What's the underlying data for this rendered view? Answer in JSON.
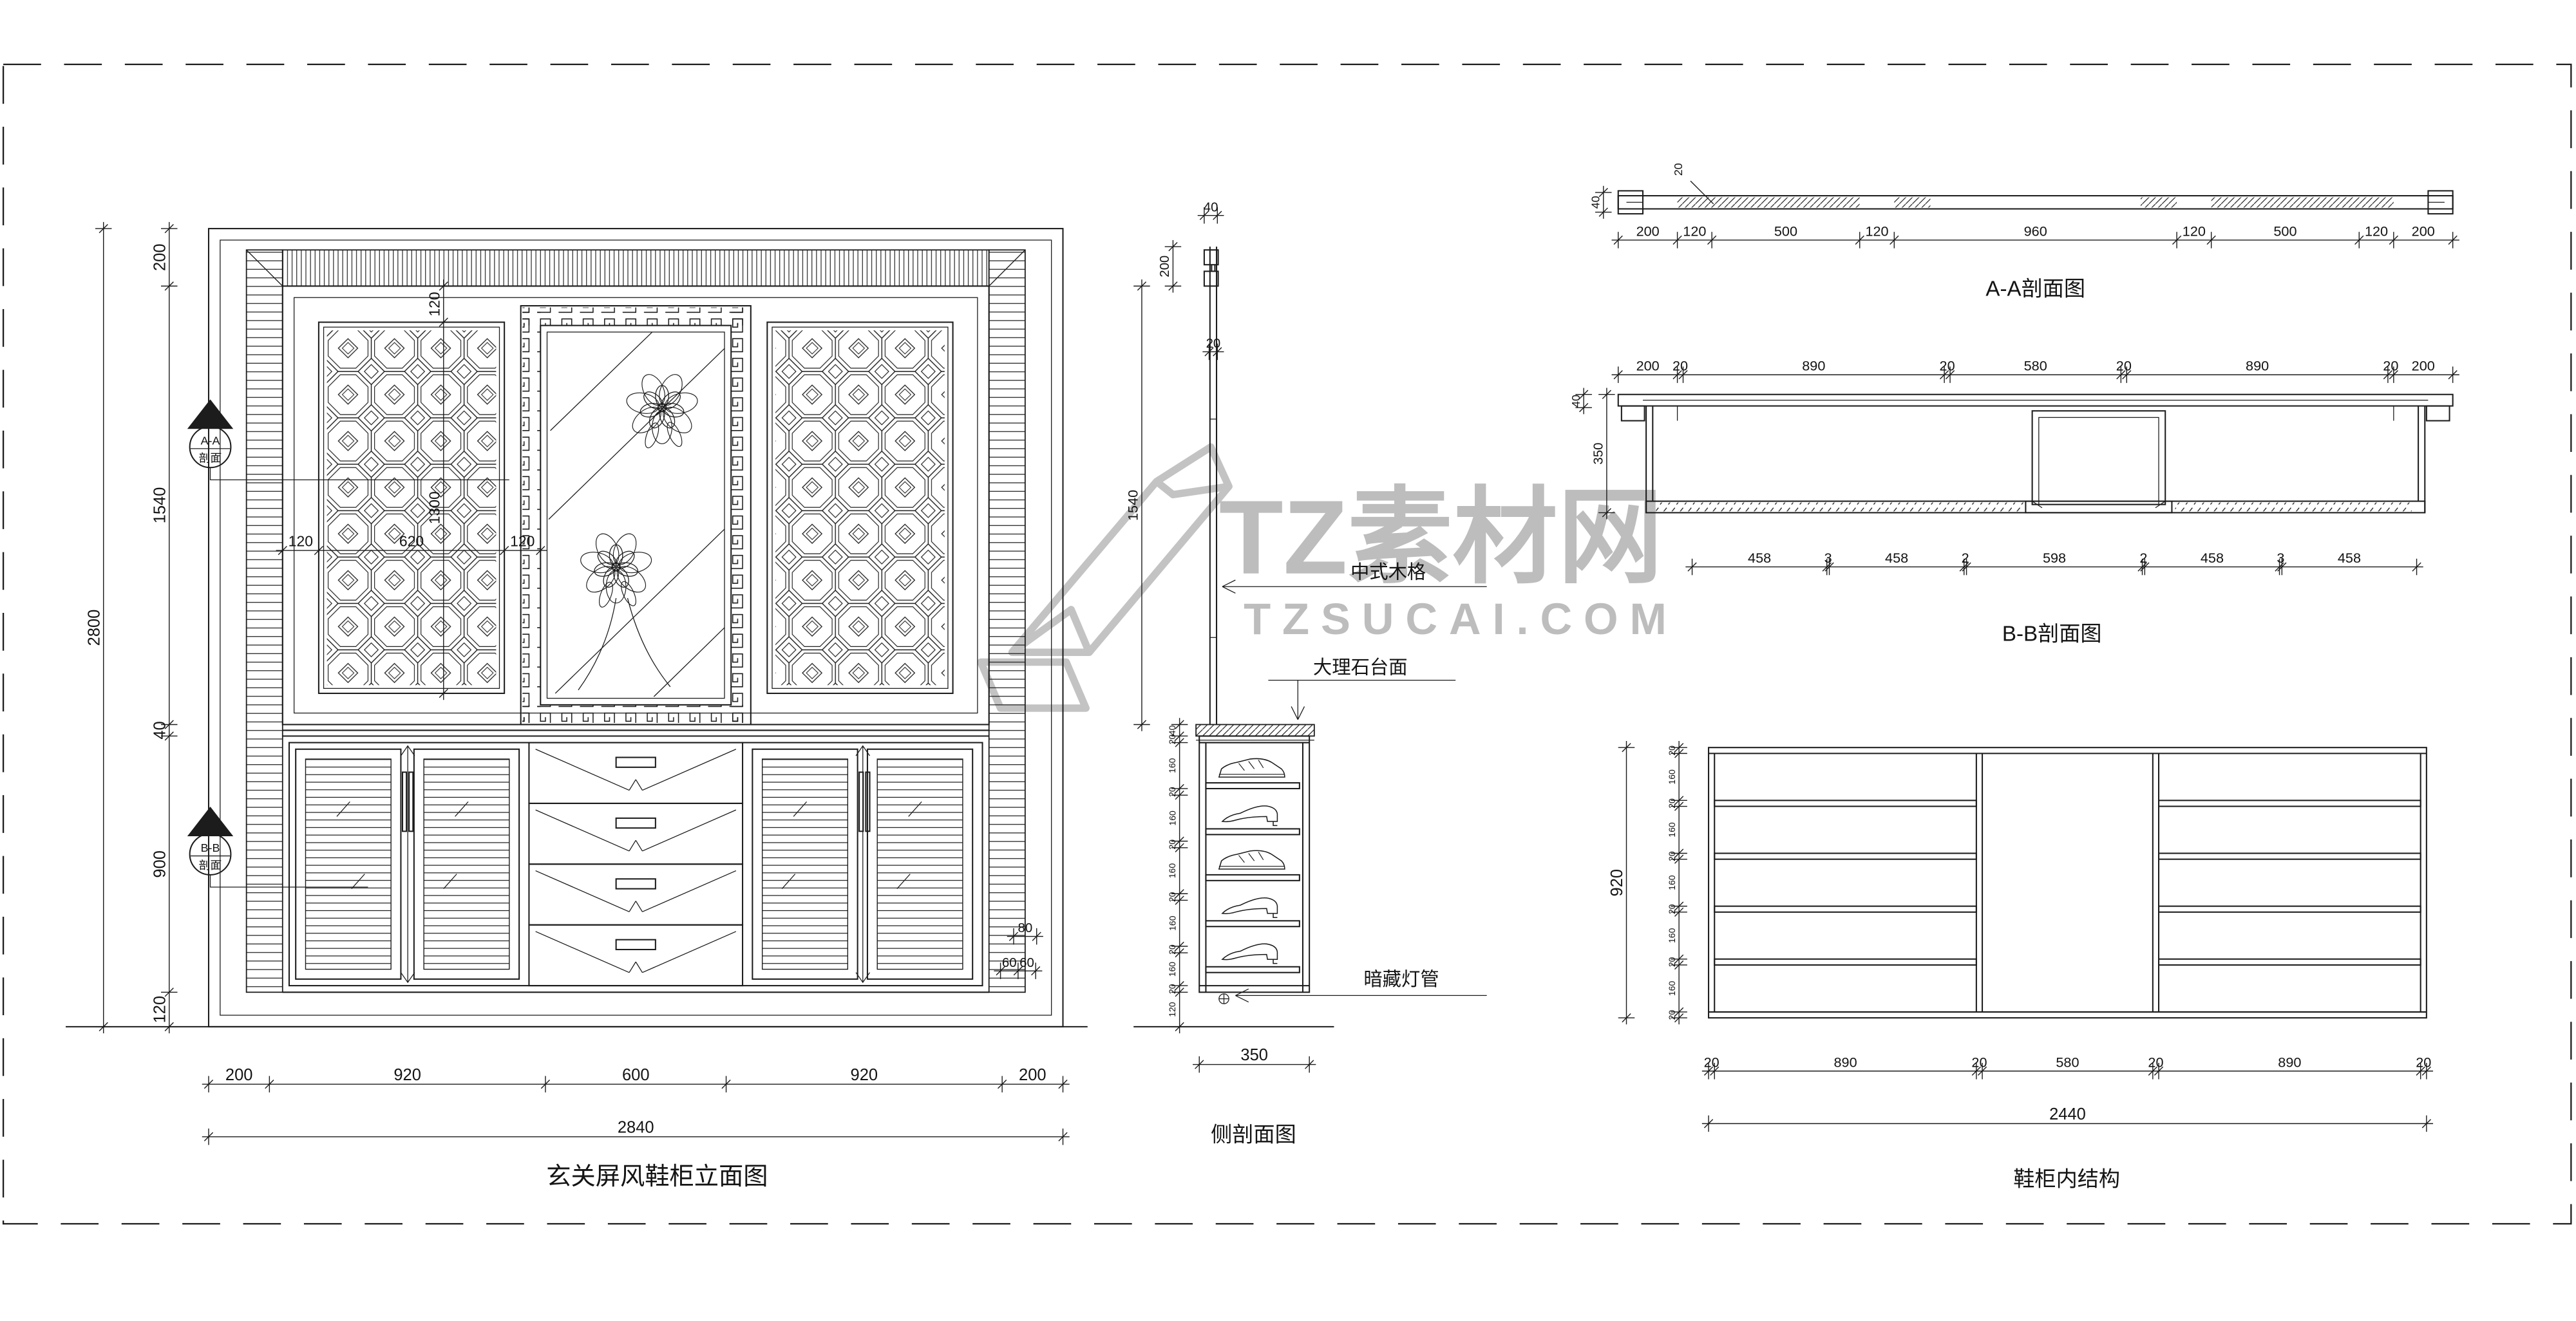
{
  "sheet": {
    "background": "#ffffff",
    "line_color": "#1c1c1c",
    "watermark_color": "#bdbdbd"
  },
  "watermark": {
    "brand": "TZ素材网",
    "domain": "TZSUCAI.COM"
  },
  "views": {
    "elevation": {
      "title": "玄关屏风鞋柜立面图",
      "section_markers": [
        {
          "name": "A-A",
          "caption": "剖面"
        },
        {
          "name": "B-B",
          "caption": "剖面"
        }
      ]
    },
    "side_section": {
      "title": "侧剖面图",
      "callouts": {
        "wood_lattice": "中式木格",
        "marble_top": "大理石台面",
        "hidden_light": "暗藏灯管"
      }
    },
    "section_aa": {
      "title": "A-A剖面图",
      "panel_thickness": "20"
    },
    "section_bb": {
      "title": "B-B剖面图"
    },
    "internal": {
      "title": "鞋柜内结构"
    }
  },
  "dim_chains": {
    "elev_bottom_segs": {
      "dir": "h",
      "pos": 660,
      "ticks": [
        127,
        164,
        332,
        442,
        610,
        647
      ],
      "labels": [
        "200",
        "920",
        "600",
        "920",
        "200"
      ],
      "size": 10
    },
    "elev_bottom_total": {
      "dir": "h",
      "pos": 692,
      "ticks": [
        127,
        647
      ],
      "labels": [
        "2840"
      ],
      "size": 10
    },
    "elev_left_segs": {
      "dir": "v",
      "pos": 103,
      "ticks": [
        139,
        174,
        441,
        448,
        604,
        625
      ],
      "labels": [
        "200",
        "1540",
        "40",
        "900",
        "120"
      ],
      "size": 10
    },
    "elev_left_total": {
      "dir": "v",
      "pos": 63,
      "ticks": [
        139,
        625
      ],
      "labels": [
        "2800"
      ],
      "size": 10
    },
    "elev_screen_w": {
      "dir": "h",
      "pos": 335,
      "ticks": [
        172,
        194,
        307,
        329
      ],
      "labels": [
        "120",
        "620",
        "120"
      ],
      "size": 9
    },
    "elev_screen_v": {
      "dir": "v",
      "pos": 270,
      "ticks": [
        174,
        196,
        422
      ],
      "labels": [
        "120",
        "1300"
      ],
      "size": 9
    },
    "elev_right_80": {
      "dir": "h",
      "pos": 570,
      "ticks": [
        617,
        631
      ],
      "labels": [
        "80"
      ],
      "size": 8
    },
    "elev_right_60": {
      "dir": "h",
      "pos": 591,
      "ticks": [
        609,
        619.7,
        630.4
      ],
      "labels": [
        "60",
        "60"
      ],
      "size": 8
    },
    "side_top_40": {
      "dir": "h",
      "pos": 131,
      "ticks": [
        733,
        741
      ],
      "labels": [
        "40"
      ],
      "size": 8
    },
    "side_crown_200": {
      "dir": "v",
      "pos": 714,
      "ticks": [
        150,
        174
      ],
      "labels": [
        "200"
      ],
      "size": 8
    },
    "side_panel_20": {
      "dir": "h",
      "pos": 214,
      "ticks": [
        736,
        741
      ],
      "labels": [
        "20"
      ],
      "size": 8
    },
    "side_screen_1540": {
      "dir": "v",
      "pos": 695,
      "ticks": [
        174,
        441
      ],
      "labels": [
        "1540"
      ],
      "size": 8.5
    },
    "side_shelf_chain": {
      "dir": "v",
      "pos": 718,
      "ticks": [
        441,
        448,
        452,
        480,
        484,
        512,
        516,
        544,
        548,
        576,
        580,
        600,
        604,
        625
      ],
      "labels": [
        "40",
        "20",
        "160",
        "20",
        "160",
        "20",
        "160",
        "20",
        "160",
        "20",
        "160",
        "20",
        "120"
      ],
      "size": 5.5
    },
    "side_depth_350": {
      "dir": "h",
      "pos": 648,
      "ticks": [
        730,
        797
      ],
      "labels": [
        "350"
      ],
      "size": 10
    },
    "aa_dims": {
      "dir": "h",
      "pos": 146,
      "ticks": [
        985,
        1021,
        1042,
        1132,
        1153,
        1325,
        1346,
        1436,
        1457,
        1493
      ],
      "labels": [
        "200",
        "120",
        "500",
        "120",
        "960",
        "120",
        "500",
        "120",
        "200"
      ],
      "size": 8.5
    },
    "aa_h40": {
      "dir": "v",
      "pos": 976,
      "ticks": [
        117,
        129
      ],
      "labels": [
        "40"
      ],
      "size": 7
    },
    "bb_top_dims": {
      "dir": "h",
      "pos": 228,
      "ticks": [
        985,
        1021,
        1024.5,
        1183.5,
        1187,
        1291,
        1294.5,
        1453.5,
        1457,
        1493
      ],
      "labels": [
        "200",
        "20",
        "890",
        "20",
        "580",
        "20",
        "890",
        "20",
        "200"
      ],
      "size": 8.5
    },
    "bb_left_350": {
      "dir": "v",
      "pos": 978,
      "ticks": [
        240,
        312
      ],
      "labels": [
        "350"
      ],
      "size": 8
    },
    "bb_left_40": {
      "dir": "v",
      "pos": 964,
      "ticks": [
        240,
        248
      ],
      "labels": [
        "40"
      ],
      "size": 7
    },
    "bb_bottom_dims": {
      "dir": "h",
      "pos": 345,
      "ticks": [
        1030,
        1112,
        1113.5,
        1195.5,
        1197,
        1304,
        1305.5,
        1387.5,
        1389,
        1471
      ],
      "labels": [
        "458",
        "3",
        "458",
        "2",
        "598",
        "2",
        "458",
        "3",
        "458"
      ],
      "size": 8.5
    },
    "int_tiny_chain": {
      "dir": "v",
      "pos": 1022,
      "ticks": [
        455,
        458.6,
        487.2,
        490.8,
        519.4,
        523,
        551.6,
        555.2,
        583.8,
        587.4,
        616,
        619.6
      ],
      "labels": [
        "20",
        "160",
        "20",
        "160",
        "20",
        "160",
        "20",
        "160",
        "20",
        "160",
        "20"
      ],
      "size": 5.5
    },
    "int_total_920": {
      "dir": "v",
      "pos": 990,
      "ticks": [
        455,
        619.6
      ],
      "labels": [
        "920"
      ],
      "size": 10
    },
    "int_bottom_segs": {
      "dir": "h",
      "pos": 652,
      "ticks": [
        1040,
        1043.6,
        1203,
        1206.6,
        1310.4,
        1314,
        1473.4,
        1477
      ],
      "labels": [
        "20",
        "890",
        "20",
        "580",
        "20",
        "890",
        "20"
      ],
      "size": 8.5
    },
    "int_bottom_total": {
      "dir": "h",
      "pos": 684,
      "ticks": [
        1040,
        1477
      ],
      "labels": [
        "2440"
      ],
      "size": 10
    }
  }
}
